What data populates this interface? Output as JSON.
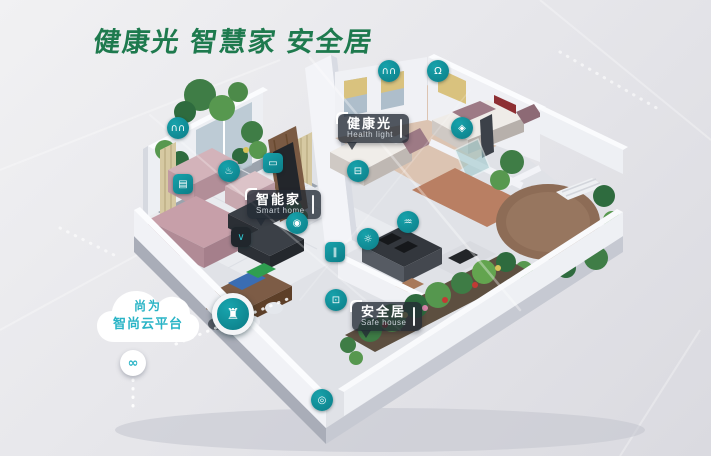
{
  "title": "健康光 智慧家 安全居",
  "colors": {
    "title_green": "#1e7a4e",
    "icon_teal": "#0e8c96",
    "cloud_text_teal": "#2ab4c6",
    "label_bg": "rgba(35,42,52,0.78)"
  },
  "cloud": {
    "line1": "尚为",
    "line2": "智尚云平台"
  },
  "labels": {
    "health_light": {
      "zh": "健康光",
      "en": "Health light"
    },
    "smart_home": {
      "zh": "智能家",
      "en": "Smart home"
    },
    "safe_house": {
      "zh": "安全居",
      "en": "Safe house"
    }
  },
  "icons": [
    {
      "name": "curtain-icon",
      "glyph": "∩∩",
      "x": 178,
      "y": 128,
      "shape": "circle"
    },
    {
      "name": "switch-panel-icon",
      "glyph": "▤",
      "x": 183,
      "y": 184,
      "shape": "square"
    },
    {
      "name": "humidifier-icon",
      "glyph": "♨",
      "x": 229,
      "y": 171,
      "shape": "circle"
    },
    {
      "name": "fresh-air-icon",
      "glyph": "▭",
      "x": 273,
      "y": 163,
      "shape": "square"
    },
    {
      "name": "voice-assistant-icon",
      "glyph": "∨",
      "x": 241,
      "y": 237,
      "shape": "square-dark"
    },
    {
      "name": "camera-icon",
      "glyph": "◉",
      "x": 297,
      "y": 223,
      "shape": "circle"
    },
    {
      "name": "scene-switch-icon",
      "glyph": "‖",
      "x": 335,
      "y": 252,
      "shape": "square"
    },
    {
      "name": "gas-sensor-icon",
      "glyph": "☼",
      "x": 368,
      "y": 239,
      "shape": "circle"
    },
    {
      "name": "wifi-gateway-icon",
      "glyph": "♒",
      "x": 408,
      "y": 222,
      "shape": "circle"
    },
    {
      "name": "sleep-monitor-icon",
      "glyph": "⊟",
      "x": 358,
      "y": 171,
      "shape": "circle"
    },
    {
      "name": "curtain-motor-icon",
      "glyph": "∩∩",
      "x": 389,
      "y": 71,
      "shape": "circle"
    },
    {
      "name": "ceiling-light-icon",
      "glyph": "Ω",
      "x": 438,
      "y": 71,
      "shape": "circle"
    },
    {
      "name": "water-purifier-icon",
      "glyph": "◈",
      "x": 462,
      "y": 128,
      "shape": "circle"
    },
    {
      "name": "door-lock-icon",
      "glyph": "⊡",
      "x": 336,
      "y": 300,
      "shape": "circle"
    },
    {
      "name": "doorbell-camera-icon",
      "glyph": "◎",
      "x": 322,
      "y": 400,
      "shape": "circle"
    },
    {
      "name": "hub-gateway-icon",
      "glyph": "♜",
      "x": 233,
      "y": 314,
      "shape": "circle-lg"
    },
    {
      "name": "cloud-link-icon",
      "glyph": "∞",
      "x": 133,
      "y": 363,
      "shape": "circle-white"
    }
  ]
}
